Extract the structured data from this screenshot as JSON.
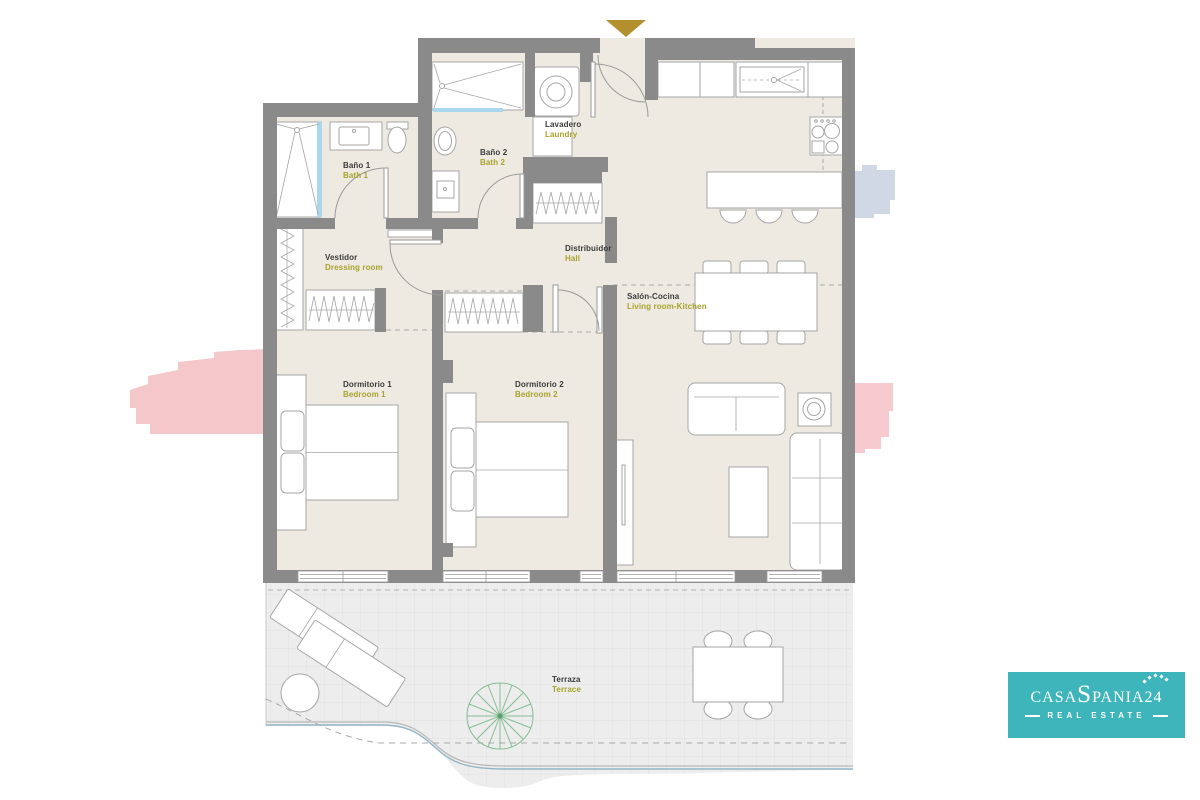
{
  "page": {
    "background": "#ffffff"
  },
  "colors": {
    "wall": "#8a8a8a",
    "floor": "#efeae1",
    "terrace_floor": "#ededed",
    "water_blue": "#a9d7ee",
    "label_dark": "#3b3b3a",
    "label_olive": "#a8a22e",
    "gold": "#b3902d",
    "logo_teal": "#3eb5ba",
    "blob_pink": "#f3c2c7",
    "blob_blue": "#ccd4e3",
    "plant_green": "#86bd95"
  },
  "rooms": {
    "bano1": {
      "es": "Baño 1",
      "en": "Bath 1"
    },
    "bano2": {
      "es": "Baño 2",
      "en": "Bath 2"
    },
    "lavadero": {
      "es": "Lavadero",
      "en": "Laundry"
    },
    "vestidor": {
      "es": "Vestidor",
      "en": "Dressing room"
    },
    "distribuidor": {
      "es": "Distribuidor",
      "en": "Hall"
    },
    "salon": {
      "es": "Salón-Cocina",
      "en": "Living room-Kitchen"
    },
    "dormitorio1": {
      "es": "Dormitorio 1",
      "en": "Bedroom 1"
    },
    "dormitorio2": {
      "es": "Dormitorio 2",
      "en": "Bedroom 2"
    },
    "terraza": {
      "es": "Terraza",
      "en": "Terrace"
    }
  },
  "logo": {
    "part1": "CASA",
    "part2": "S",
    "part3": "PANIA",
    "part4": "24",
    "tagline": "REAL ESTATE"
  }
}
